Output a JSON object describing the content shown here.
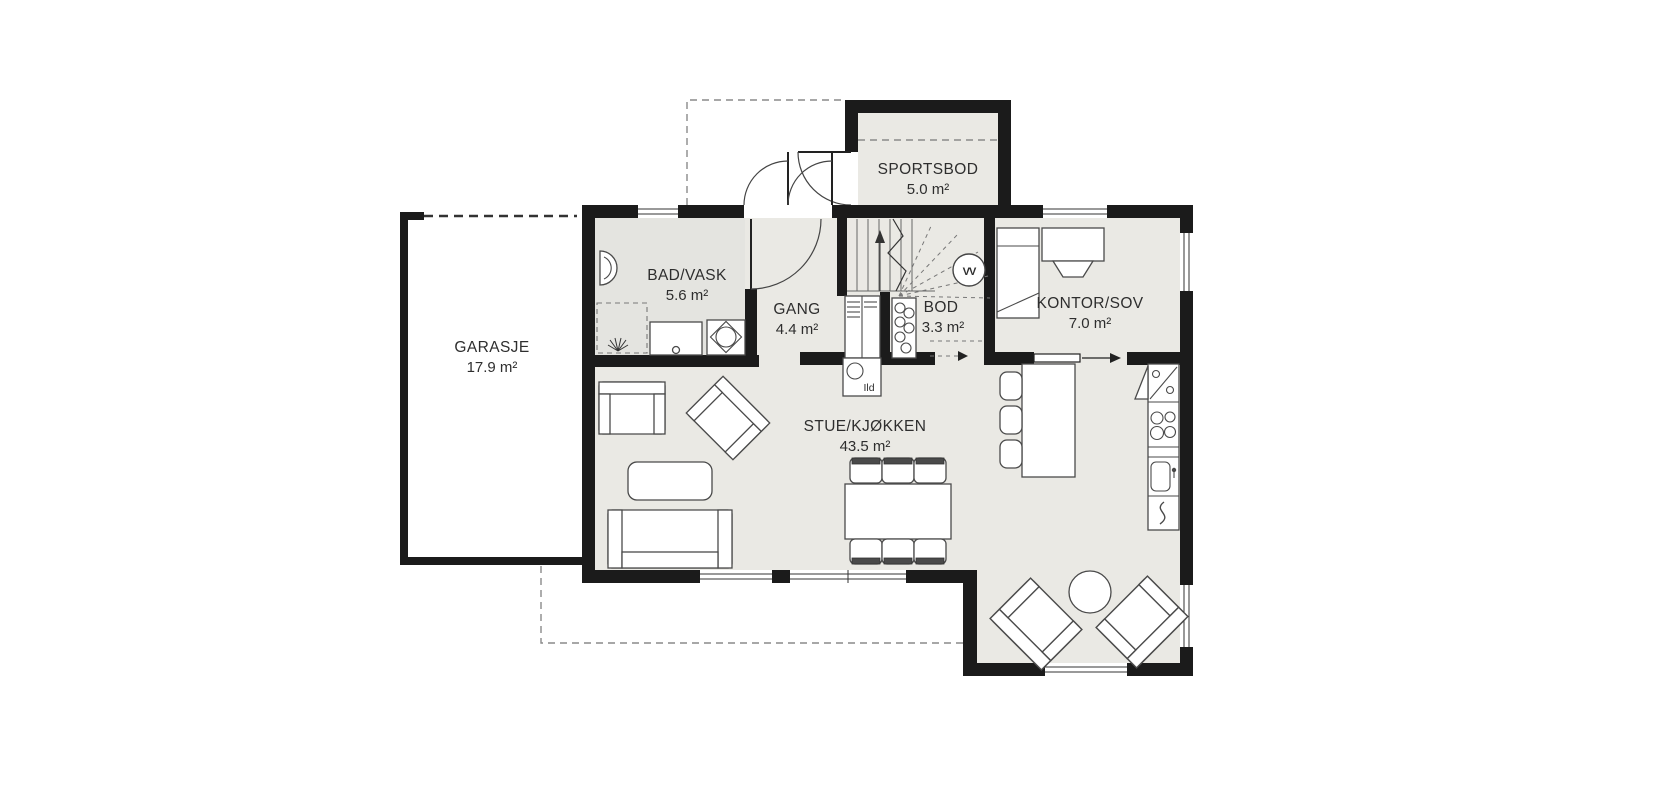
{
  "plan": {
    "rooms": {
      "garasje": {
        "name": "GARASJE",
        "area": "17.9 m²"
      },
      "sportsbod": {
        "name": "SPORTSBOD",
        "area": "5.0 m²"
      },
      "bad": {
        "name": "BAD/VASK",
        "area": "5.6 m²"
      },
      "gang": {
        "name": "GANG",
        "area": "4.4 m²"
      },
      "bod": {
        "name": "BOD",
        "area": "3.3 m²"
      },
      "kontor": {
        "name": "KONTOR/SOV",
        "area": "7.0 m²"
      },
      "stue": {
        "name": "STUE/KJØKKEN",
        "area": "43.5 m²"
      }
    },
    "annotations": {
      "fireplace": "Ild",
      "water_heater": "VV"
    },
    "colors": {
      "wall": "#1b1b1b",
      "floor": "#eae9e4",
      "bathroom_floor": "#e4e4e0",
      "background": "#ffffff",
      "furniture_line": "#4a4a4a"
    }
  }
}
